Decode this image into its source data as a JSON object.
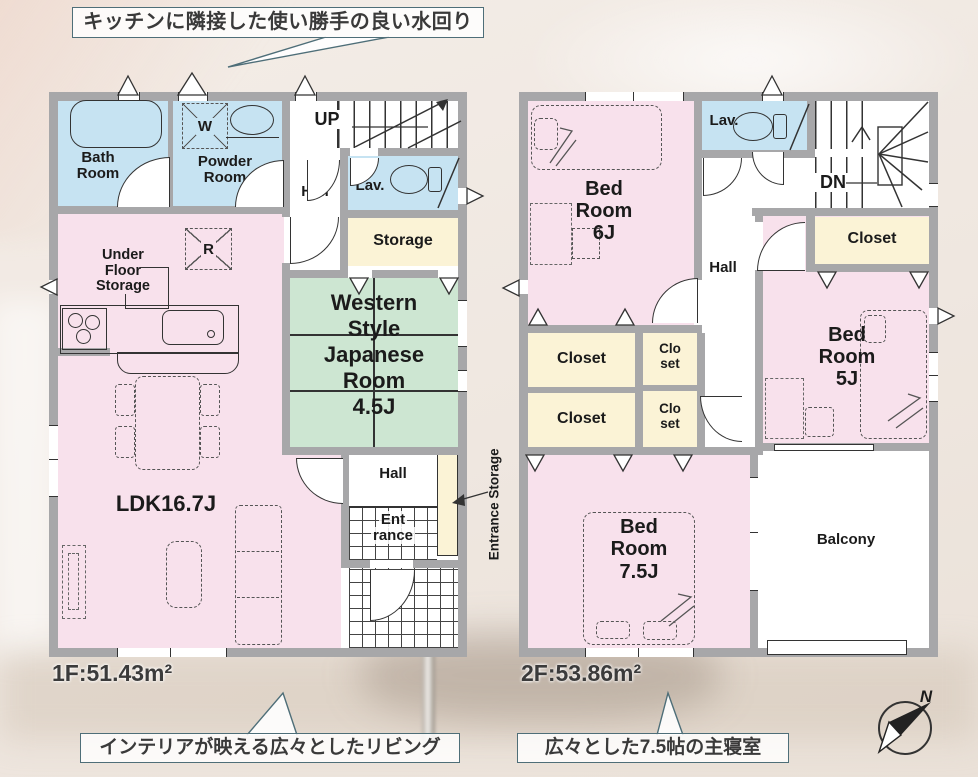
{
  "callouts": {
    "top": "キッチンに隣接した使い勝手の良い水回り",
    "bottom_left": "インテリアが映える広々としたリビング",
    "bottom_right": "広々とした7.5帖の主寝室"
  },
  "floor1": {
    "area_label": "1F:51.43m²",
    "labels": {
      "bath": [
        "Bath",
        "Room"
      ],
      "powder": [
        "Powder",
        "Room"
      ],
      "washer": "W",
      "up": "UP",
      "hall_upper": "Hall",
      "lav": "Lav.",
      "storage": "Storage",
      "fridge": "R",
      "under_floor": [
        "Under",
        "Floor",
        "Storage"
      ],
      "japanese": [
        "Western",
        "Style",
        "Japanese",
        "Room",
        "4.5J"
      ],
      "ldk": "LDK16.7J",
      "hall_lower": "Hall",
      "entrance": [
        "Ent",
        "rance"
      ],
      "entrance_storage": "Entrance Storage"
    }
  },
  "floor2": {
    "area_label": "2F:53.86m²",
    "labels": {
      "bed6": [
        "Bed",
        "Room",
        "6J"
      ],
      "lav": "Lav.",
      "dn": "DN",
      "closet_top": "Closet",
      "hall": "Hall",
      "bed5": [
        "Bed",
        "Room",
        "5J"
      ],
      "closet_a": "Closet",
      "closet_b": "Closet",
      "closet_small_a": [
        "Clo",
        "set"
      ],
      "closet_small_b": [
        "Clo",
        "set"
      ],
      "bed75": [
        "Bed",
        "Room",
        "7.5J"
      ],
      "balcony": "Balcony"
    }
  },
  "compass": {
    "north_label": "N"
  },
  "colors": {
    "wall": "#a7a7a9",
    "room_pink": "#f8e1ec",
    "room_blue": "#c6e3f2",
    "room_green": "#cde6d2",
    "room_cream": "#fbf3d6",
    "callout_border": "#4e6e78"
  }
}
